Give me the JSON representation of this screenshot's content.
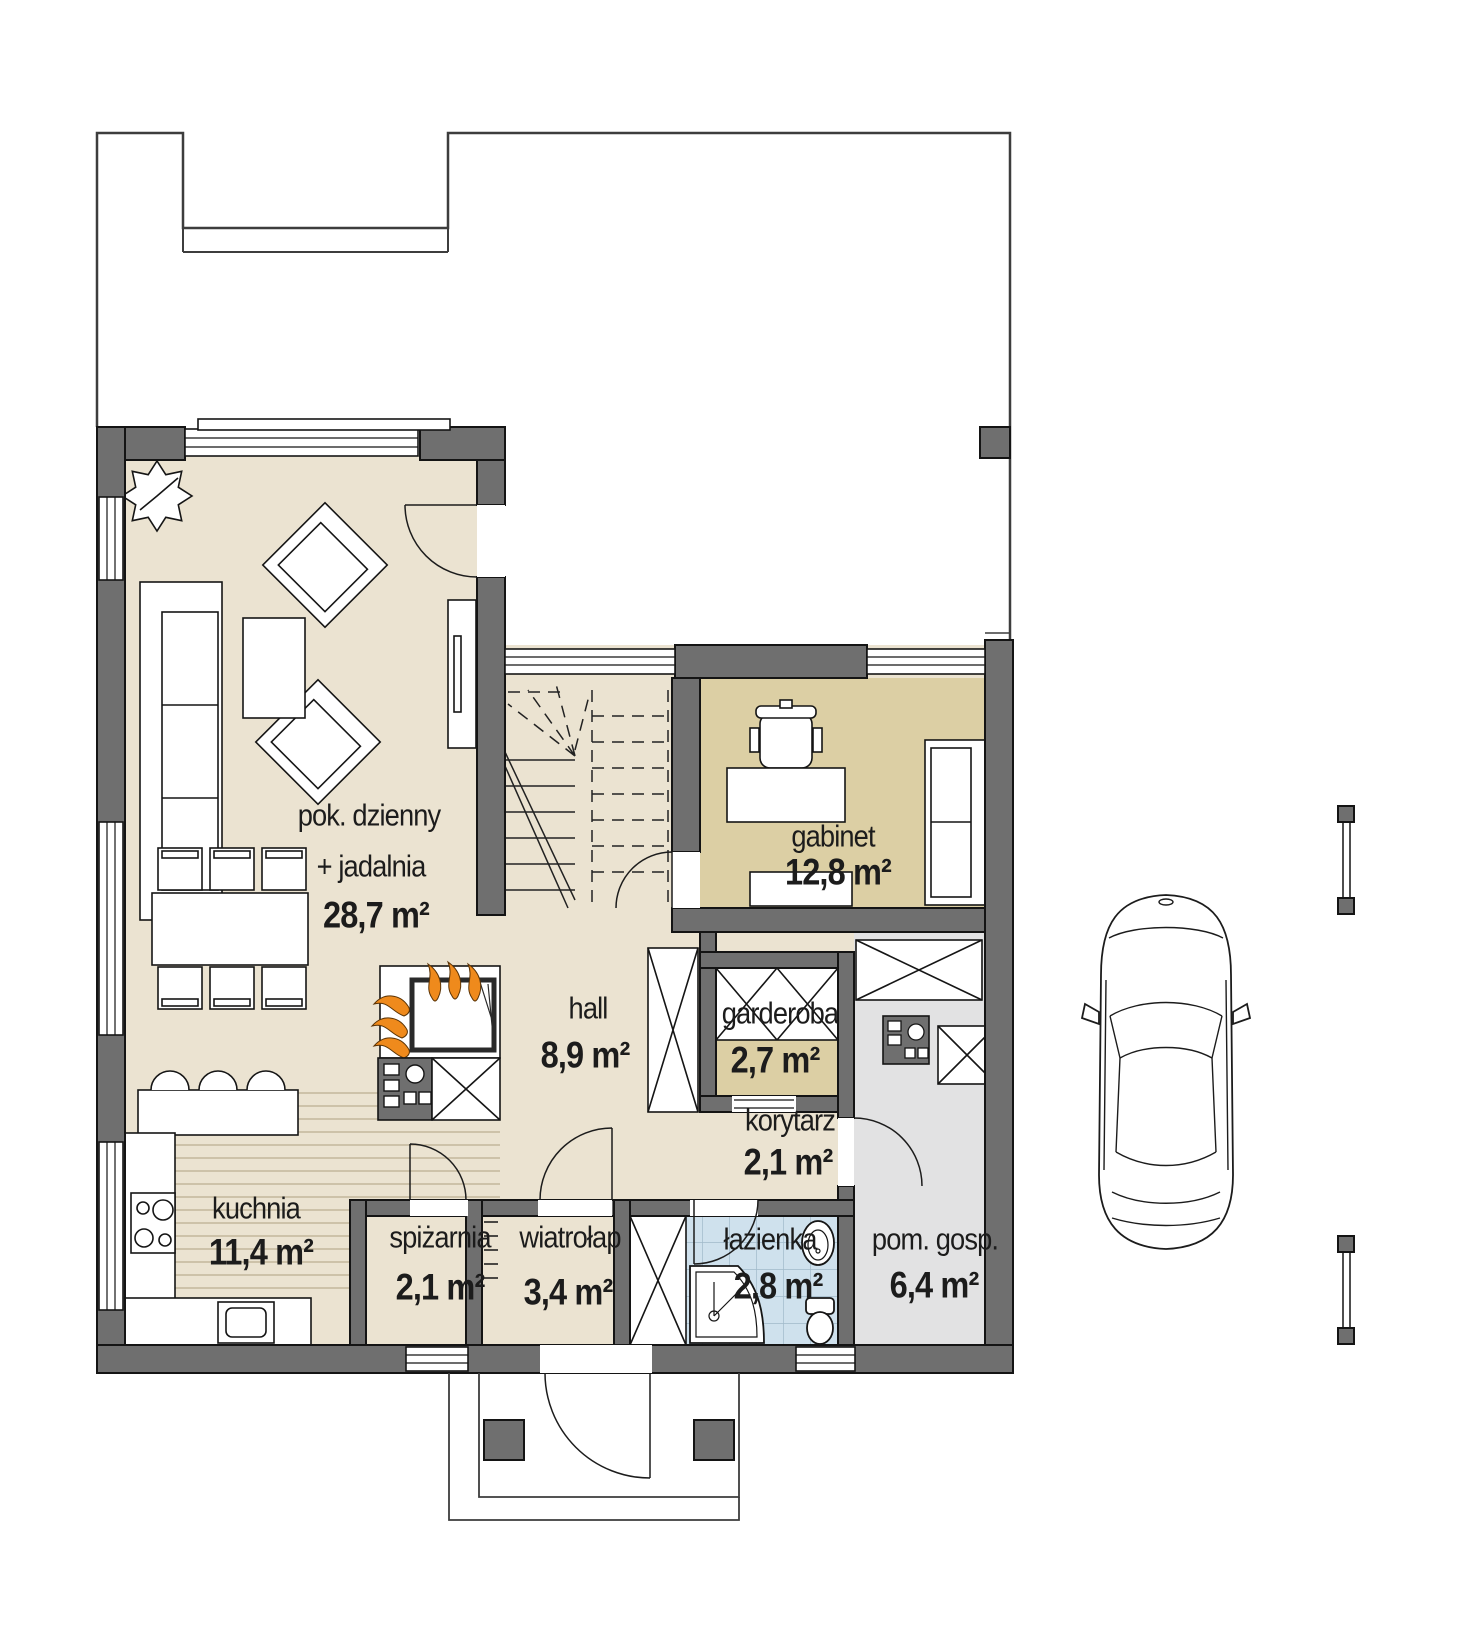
{
  "plan": {
    "type": "floor-plan",
    "rooms": [
      {
        "id": "living-dining",
        "name": "pok. dzienny",
        "name2": "+ jadalnia",
        "area": "28,7 m²"
      },
      {
        "id": "gabinet",
        "name": "gabinet",
        "area": "12,8 m²"
      },
      {
        "id": "hall",
        "name": "hall",
        "area": "8,9 m²"
      },
      {
        "id": "garderoba",
        "name": "garderoba",
        "area": "2,7 m²"
      },
      {
        "id": "korytarz",
        "name": "korytarz",
        "area": "2,1 m²"
      },
      {
        "id": "kuchnia",
        "name": "kuchnia",
        "area": "11,4 m²"
      },
      {
        "id": "spizarnia",
        "name": "spiżarnia",
        "area": "2,1 m²"
      },
      {
        "id": "wiatrolap",
        "name": "wiatrołap",
        "area": "3,4 m²"
      },
      {
        "id": "lazienka",
        "name": "łazienka",
        "area": "2,8 m²"
      },
      {
        "id": "pom-gosp",
        "name": "pom. gosp.",
        "area": "6,4 m²"
      }
    ],
    "objects": [
      "car-top-view",
      "gate-posts",
      "plant",
      "fireplace",
      "staircase",
      "dining-table",
      "sofa",
      "armchair",
      "bar-stools",
      "kitchen-counter",
      "shower",
      "toilet",
      "washbasin",
      "wardrobe",
      "entrance-porch"
    ],
    "colors": {
      "wall": "#6f6f6f",
      "floor_cream": "#ebe3d1",
      "floor_tan": "#dccfa4",
      "floor_gray": "#e2e2e3",
      "floor_blue": "#cfe1ed",
      "flame_orange": "#ef8a1c",
      "line": "#1c1c1c"
    }
  }
}
